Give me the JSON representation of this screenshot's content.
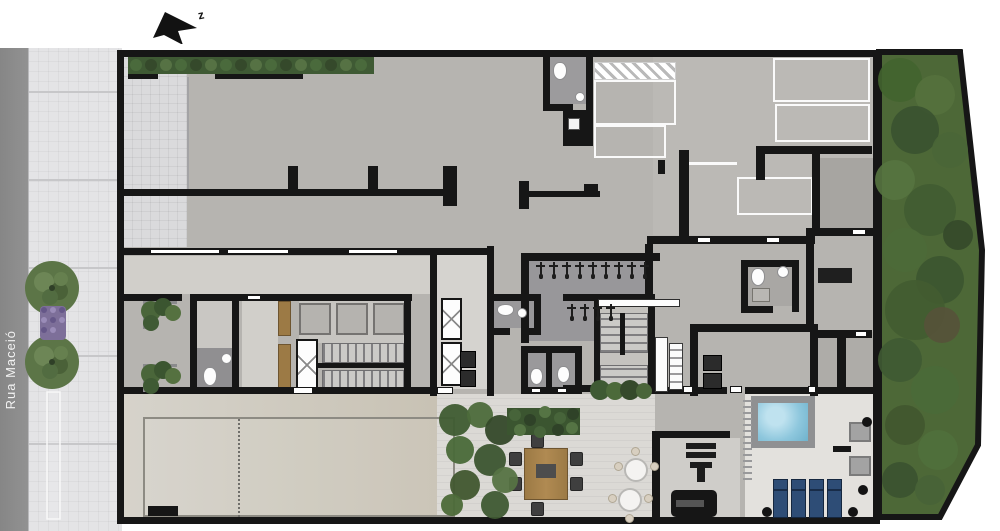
{
  "plan": {
    "street_label": "Rua Maceió",
    "north_label": "z"
  },
  "palette": {
    "wall": "#161616",
    "street": "#8d8d8d",
    "sidewalk": "#e4e4e6",
    "garage_floor": "#b6b4b0",
    "room_floor_light": "#d2d0cc",
    "room_floor_dark": "#9a999b",
    "garden_green": "#4d6837",
    "hedge_green": "#3f5a34",
    "pool_water": "#8ec7dd",
    "pool_deck": "#e3e1dd",
    "sunbed_blue": "#2e4d76",
    "wood": "#9c7a45",
    "paving_tan": "#cfc9bd"
  },
  "counts": {
    "bike_rack_row_top": 9,
    "bike_rack_row_bottom": 4,
    "sun_loungers": 4,
    "street_trees": 2,
    "bistro_tables": 2,
    "dining_chairs": 6,
    "parking_space_outlines": 5,
    "pool_deck_spotlights": 4
  }
}
